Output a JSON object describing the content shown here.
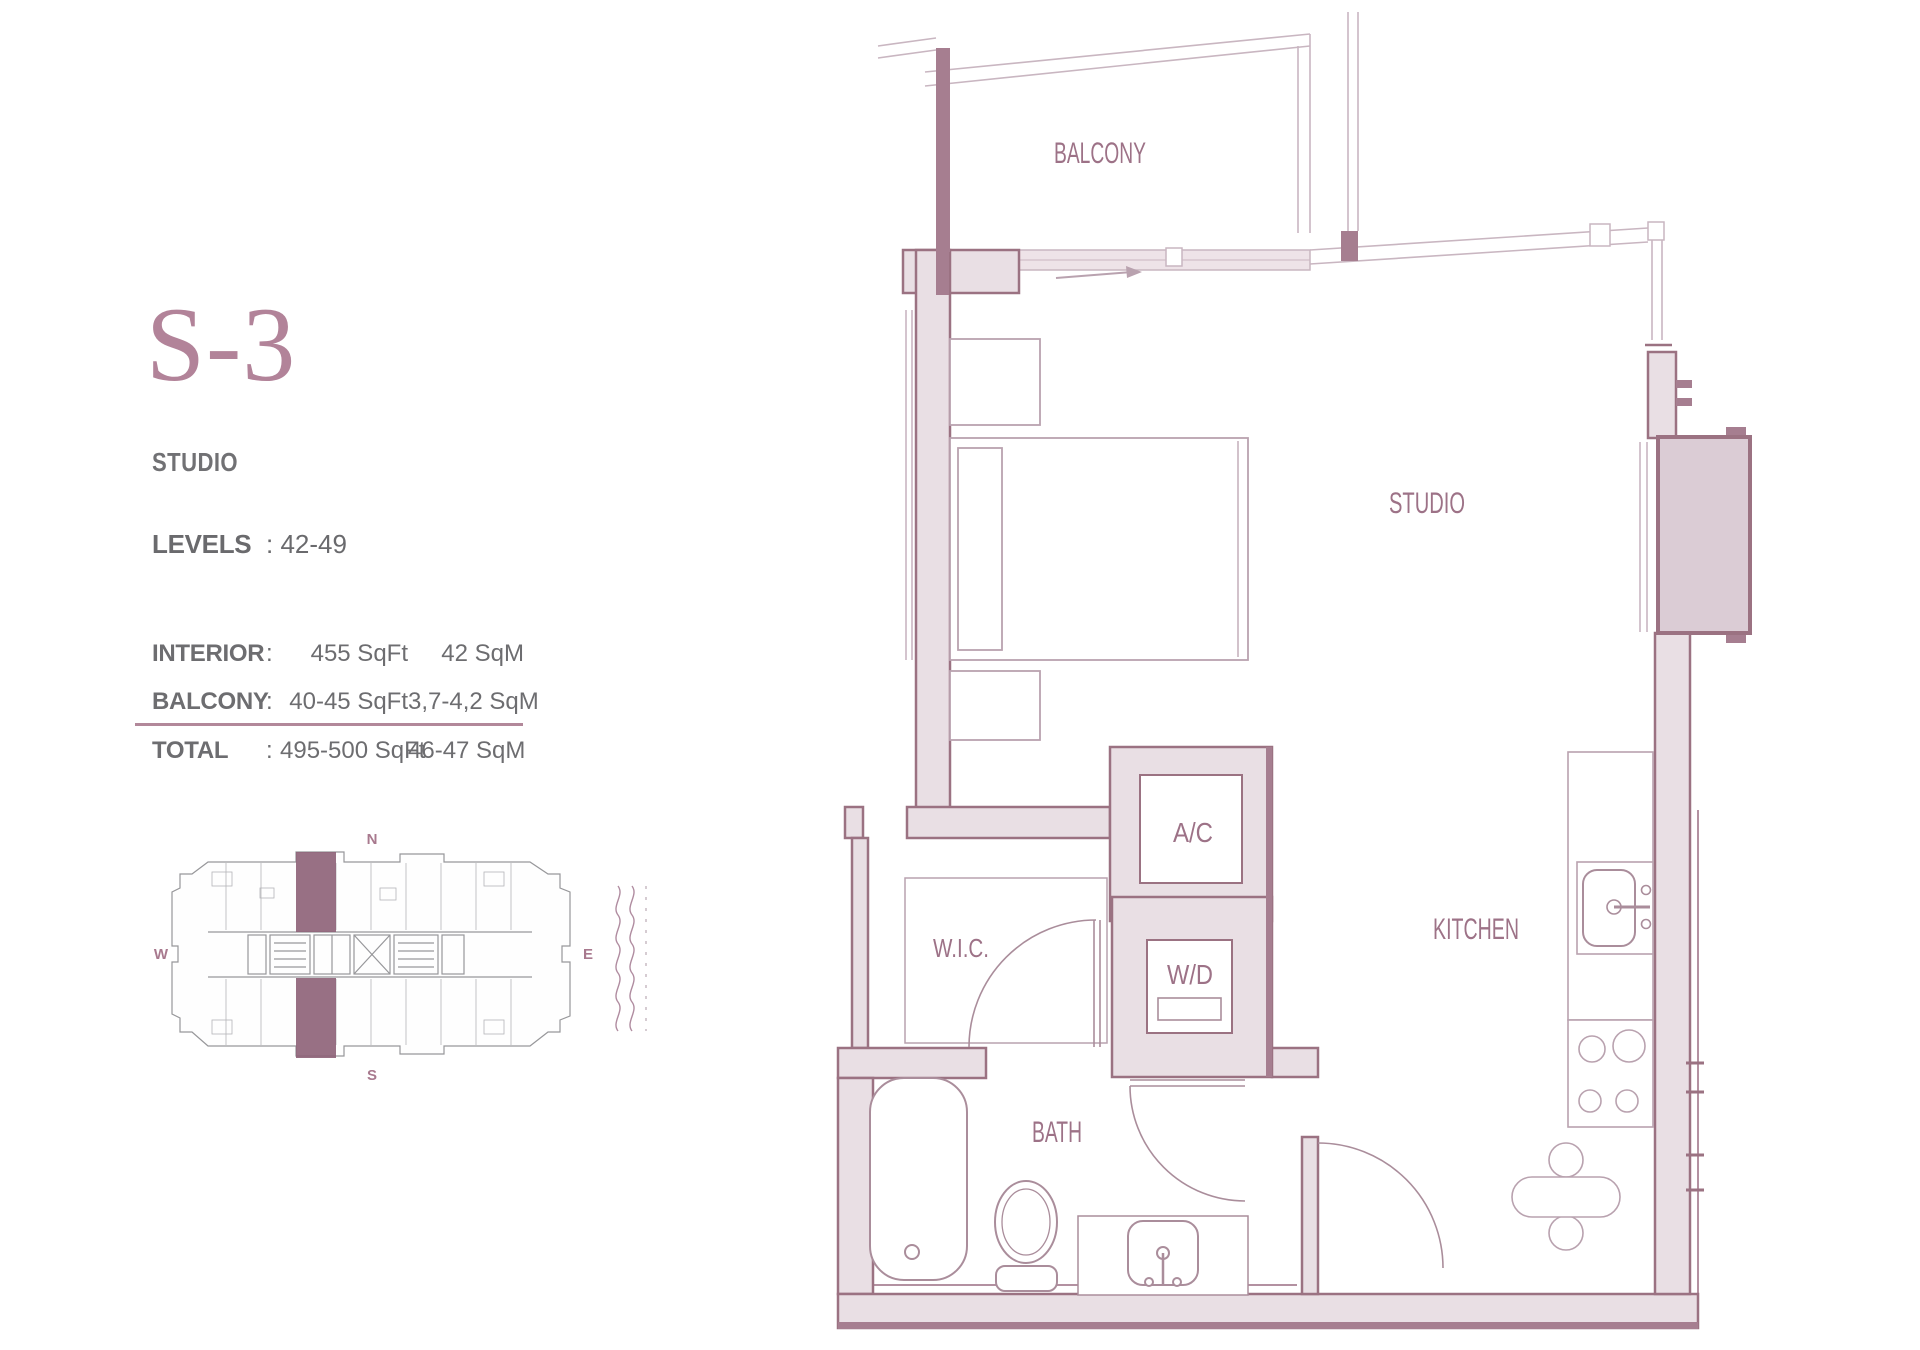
{
  "panel": {
    "unit_code": "S-3",
    "unit_type": "STUDIO",
    "levels": {
      "label": "LEVELS",
      "value": ": 42-49"
    },
    "area_table": {
      "rows": [
        {
          "label": "INTERIOR",
          "colon": ":",
          "imperial": "455 SqFt",
          "metric": "42 SqM"
        },
        {
          "label": "BALCONY",
          "colon": ":",
          "imperial": "40-45 SqFt",
          "metric": "3,7-4,2 SqM"
        },
        {
          "label": "TOTAL",
          "colon": ":",
          "imperial": "495-500 SqFt",
          "metric": "46-47 SqM"
        }
      ]
    }
  },
  "keyplan": {
    "compass": {
      "n": "N",
      "s": "S",
      "w": "W",
      "e": "E"
    }
  },
  "floorplan": {
    "rooms": {
      "balcony": "BALCONY",
      "studio": "STUDIO",
      "kitchen": "KITCHEN",
      "bath": "BATH",
      "wic": "W.I.C.",
      "ac": "A/C",
      "wd": "W/D"
    }
  },
  "colors": {
    "title": "#b28399",
    "accent_label": "#9d7287",
    "wall_outline": "#9b7282",
    "wall_fill": "#e9dfe4",
    "wall_solid": "#a67e90",
    "bay_fill": "#dbccd5",
    "fixture_line": "#aa8d9b",
    "light_line": "#c9b6c1",
    "text_gray": "#6d6d70",
    "divider": "#b2889a"
  }
}
